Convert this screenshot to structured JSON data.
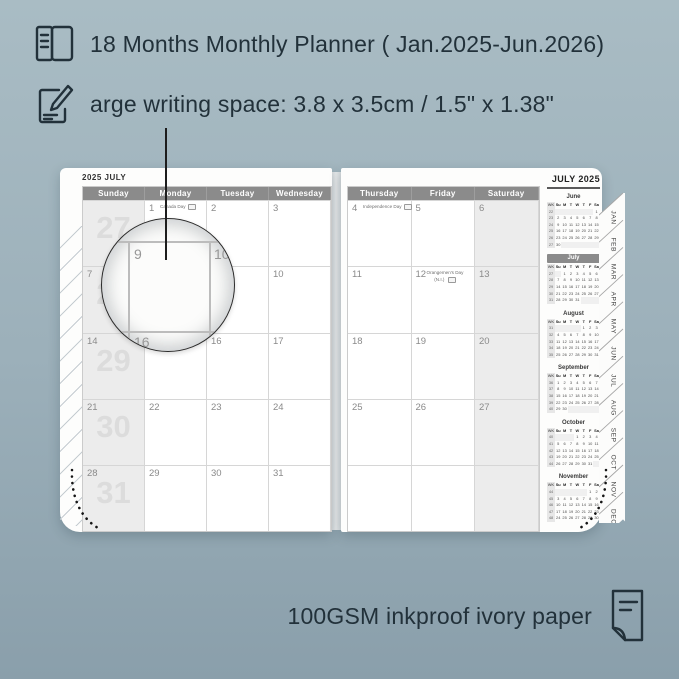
{
  "colors": {
    "background_top": "#a9bcc4",
    "background_bottom": "#8a9fab",
    "ink": "#22313a",
    "header_bar": "#8b8b8b",
    "shaded_column": "#ececec",
    "grid_line": "#d6d6d6",
    "week_watermark": "#dcdcdc",
    "page": "#fdfdfc"
  },
  "features": {
    "line1": "18 Months Monthly Planner ( Jan.2025-Jun.2026)",
    "line2": "arge writing space: 3.8 x 3.5cm / 1.5\" x 1.38\"",
    "line3": "100GSM inkproof ivory paper"
  },
  "planner": {
    "left_title": "2025 JULY",
    "right_title": "JULY 2025",
    "left_day_headers": [
      "Sunday",
      "Monday",
      "Tuesday",
      "Wednesday"
    ],
    "right_day_headers": [
      "Thursday",
      "Friday",
      "Saturday"
    ],
    "left_rows": [
      {
        "week_big": "27",
        "sun": "",
        "cells": [
          {
            "d": "1",
            "h": "Canada Day"
          },
          {
            "d": "2"
          },
          {
            "d": "3"
          }
        ]
      },
      {
        "week_big": "28",
        "sun": "7",
        "cells": [
          {
            "d": "8"
          },
          {
            "d": "9"
          },
          {
            "d": "10"
          }
        ]
      },
      {
        "week_big": "29",
        "sun": "14",
        "cells": [
          {
            "d": "15"
          },
          {
            "d": "16"
          },
          {
            "d": "17"
          }
        ]
      },
      {
        "week_big": "30",
        "sun": "21",
        "cells": [
          {
            "d": "22"
          },
          {
            "d": "23"
          },
          {
            "d": "24"
          }
        ]
      },
      {
        "week_big": "31",
        "sun": "28",
        "cells": [
          {
            "d": "29"
          },
          {
            "d": "30"
          },
          {
            "d": "31"
          }
        ]
      }
    ],
    "right_rows": [
      {
        "cells": [
          {
            "d": "4",
            "h": "Independence Day"
          },
          {
            "d": "5"
          }
        ],
        "sat": "6"
      },
      {
        "cells": [
          {
            "d": "11"
          },
          {
            "d": "12",
            "h": "Orangemen's Day",
            "h2": "(N.I.)"
          }
        ],
        "sat": "13"
      },
      {
        "cells": [
          {
            "d": "18"
          },
          {
            "d": "19"
          }
        ],
        "sat": "20"
      },
      {
        "cells": [
          {
            "d": "25"
          },
          {
            "d": "26"
          }
        ],
        "sat": "27"
      },
      {
        "cells": [
          {
            "d": ""
          },
          {
            "d": ""
          }
        ],
        "sat": ""
      }
    ],
    "mini_header": [
      "WK",
      "Su",
      "M",
      "T",
      "W",
      "T",
      "F",
      "Sa"
    ],
    "mini_months": [
      {
        "name": "June",
        "weeks": [
          {
            "wk": "22",
            "days": [
              "",
              "",
              "",
              "",
              "",
              "",
              "1"
            ]
          },
          {
            "wk": "23",
            "days": [
              "2",
              "3",
              "4",
              "5",
              "6",
              "7",
              "8"
            ]
          },
          {
            "wk": "24",
            "days": [
              "9",
              "10",
              "11",
              "12",
              "13",
              "14",
              "15"
            ]
          },
          {
            "wk": "25",
            "days": [
              "16",
              "17",
              "18",
              "19",
              "20",
              "21",
              "22"
            ]
          },
          {
            "wk": "26",
            "days": [
              "23",
              "24",
              "25",
              "26",
              "27",
              "28",
              "29"
            ]
          },
          {
            "wk": "27",
            "days": [
              "30",
              "",
              "",
              "",
              "",
              "",
              ""
            ]
          }
        ]
      },
      {
        "name": "July",
        "highlight": true,
        "weeks": [
          {
            "wk": "27",
            "days": [
              "",
              "1",
              "2",
              "3",
              "4",
              "5",
              "6"
            ]
          },
          {
            "wk": "28",
            "days": [
              "7",
              "8",
              "9",
              "10",
              "11",
              "12",
              "13"
            ]
          },
          {
            "wk": "29",
            "days": [
              "14",
              "15",
              "16",
              "17",
              "18",
              "19",
              "20"
            ]
          },
          {
            "wk": "30",
            "days": [
              "21",
              "22",
              "23",
              "24",
              "25",
              "26",
              "27"
            ]
          },
          {
            "wk": "31",
            "days": [
              "28",
              "29",
              "30",
              "31",
              "",
              "",
              ""
            ]
          }
        ]
      },
      {
        "name": "August",
        "weeks": [
          {
            "wk": "31",
            "days": [
              "",
              "",
              "",
              "",
              "1",
              "2",
              "3"
            ]
          },
          {
            "wk": "32",
            "days": [
              "4",
              "5",
              "6",
              "7",
              "8",
              "9",
              "10"
            ]
          },
          {
            "wk": "33",
            "days": [
              "11",
              "12",
              "13",
              "14",
              "15",
              "16",
              "17"
            ]
          },
          {
            "wk": "34",
            "days": [
              "18",
              "19",
              "20",
              "21",
              "22",
              "23",
              "24"
            ]
          },
          {
            "wk": "35",
            "days": [
              "25",
              "26",
              "27",
              "28",
              "29",
              "30",
              "31"
            ]
          }
        ]
      },
      {
        "name": "September",
        "weeks": [
          {
            "wk": "36",
            "days": [
              "1",
              "2",
              "3",
              "4",
              "5",
              "6",
              "7"
            ]
          },
          {
            "wk": "37",
            "days": [
              "8",
              "9",
              "10",
              "11",
              "12",
              "13",
              "14"
            ]
          },
          {
            "wk": "38",
            "days": [
              "15",
              "16",
              "17",
              "18",
              "19",
              "20",
              "21"
            ]
          },
          {
            "wk": "39",
            "days": [
              "22",
              "23",
              "24",
              "25",
              "26",
              "27",
              "28"
            ]
          },
          {
            "wk": "40",
            "days": [
              "29",
              "30",
              "",
              "",
              "",
              "",
              ""
            ]
          }
        ]
      },
      {
        "name": "October",
        "weeks": [
          {
            "wk": "40",
            "days": [
              "",
              "",
              "",
              "1",
              "2",
              "3",
              "4"
            ]
          },
          {
            "wk": "41",
            "days": [
              "5",
              "6",
              "7",
              "8",
              "9",
              "10",
              "11"
            ]
          },
          {
            "wk": "42",
            "days": [
              "12",
              "13",
              "14",
              "15",
              "16",
              "17",
              "18"
            ]
          },
          {
            "wk": "43",
            "days": [
              "19",
              "20",
              "21",
              "22",
              "23",
              "24",
              "25"
            ]
          },
          {
            "wk": "44",
            "days": [
              "26",
              "27",
              "28",
              "29",
              "30",
              "31",
              ""
            ]
          }
        ]
      },
      {
        "name": "November",
        "weeks": [
          {
            "wk": "44",
            "days": [
              "",
              "",
              "",
              "",
              "",
              "1",
              "2"
            ]
          },
          {
            "wk": "45",
            "days": [
              "3",
              "4",
              "5",
              "6",
              "7",
              "8",
              "9"
            ]
          },
          {
            "wk": "46",
            "days": [
              "10",
              "11",
              "12",
              "13",
              "14",
              "15",
              "16"
            ]
          },
          {
            "wk": "47",
            "days": [
              "17",
              "18",
              "19",
              "20",
              "21",
              "22",
              "23"
            ]
          },
          {
            "wk": "48",
            "days": [
              "24",
              "25",
              "26",
              "27",
              "28",
              "29",
              "30"
            ]
          }
        ]
      }
    ],
    "tabs": [
      "JAN",
      "FEB",
      "MAR",
      "APR",
      "MAY",
      "JUN",
      "JUL",
      "AUG",
      "SEP",
      "OCT",
      "NOV",
      "DEC"
    ]
  },
  "magnifier": {
    "n9": "9",
    "n10": "10",
    "n16": "16"
  }
}
